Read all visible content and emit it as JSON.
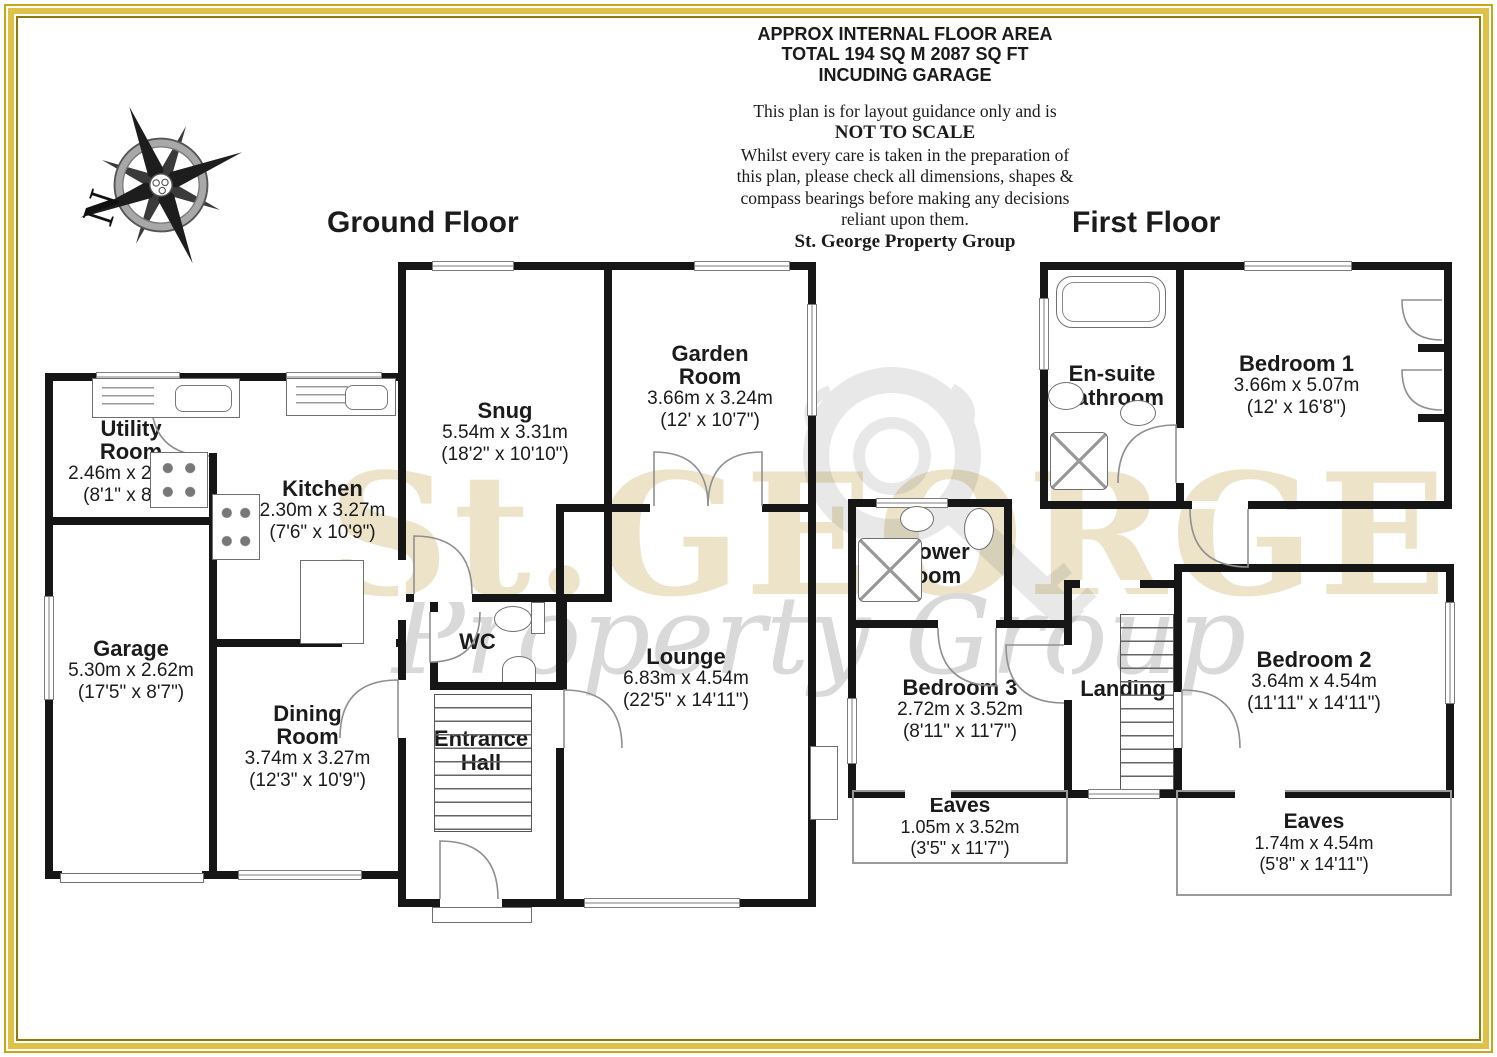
{
  "header": {
    "line1": "APPROX INTERNAL FLOOR AREA",
    "line2": "TOTAL 194 SQ M 2087 SQ FT",
    "line3": "INCUDING GARAGE",
    "disclaimer1": "This plan is for layout guidance only and is",
    "disclaimer2": "NOT TO SCALE",
    "disclaimer3": "Whilst every care is taken in the preparation of",
    "disclaimer4": "this plan, please check all dimensions, shapes &",
    "disclaimer5": "compass bearings before making any decisions",
    "disclaimer6": "reliant upon them.",
    "company": "St. George Property Group"
  },
  "compass": {
    "north_label": "N"
  },
  "watermark": {
    "primary": "St.GEORGE",
    "secondary": "Property Group"
  },
  "colors": {
    "wall": "#161616",
    "frame_gold": "#ddc247",
    "watermark_beige": "#ece3c9",
    "watermark_gray": "#d9d9d9"
  },
  "ground": {
    "title": "Ground Floor",
    "rooms": {
      "utility": {
        "name": "Utility Room",
        "metric": "2.46m x 2.62m",
        "imperial": "(8'1\" x 8'7\")"
      },
      "kitchen": {
        "name": "Kitchen",
        "metric": "2.30m x 3.27m",
        "imperial": "(7'6\" x 10'9\")"
      },
      "garage": {
        "name": "Garage",
        "metric": "5.30m x 2.62m",
        "imperial": "(17'5\" x 8'7\")"
      },
      "dining": {
        "name": "Dining Room",
        "metric": "3.74m x 3.27m",
        "imperial": "(12'3\" x 10'9\")"
      },
      "snug": {
        "name": "Snug",
        "metric": "5.54m x 3.31m",
        "imperial": "(18'2\" x 10'10\")"
      },
      "garden": {
        "name": "Garden Room",
        "metric": "3.66m x 3.24m",
        "imperial": "(12' x 10'7\")"
      },
      "wc": {
        "name": "WC"
      },
      "hall": {
        "name": "Entrance Hall"
      },
      "lounge": {
        "name": "Lounge",
        "metric": "6.83m x 4.54m",
        "imperial": "(22'5\" x 14'11\")"
      }
    }
  },
  "first": {
    "title": "First Floor",
    "rooms": {
      "ensuite": {
        "name": "En-suite Bathroom"
      },
      "bed1": {
        "name": "Bedroom 1",
        "metric": "3.66m x 5.07m",
        "imperial": "(12' x 16'8\")"
      },
      "shower": {
        "name": "Shower Room"
      },
      "bed3": {
        "name": "Bedroom 3",
        "metric": "2.72m x 3.52m",
        "imperial": "(8'11\" x 11'7\")"
      },
      "landing": {
        "name": "Landing"
      },
      "bed2": {
        "name": "Bedroom 2",
        "metric": "3.64m x 4.54m",
        "imperial": "(11'11\" x 14'11\")"
      },
      "eaves_left": {
        "name": "Eaves",
        "metric": "1.05m x 3.52m",
        "imperial": "(3'5\" x 11'7\")"
      },
      "eaves_right": {
        "name": "Eaves",
        "metric": "1.74m x 4.54m",
        "imperial": "(5'8\" x 14'11\")"
      }
    }
  }
}
